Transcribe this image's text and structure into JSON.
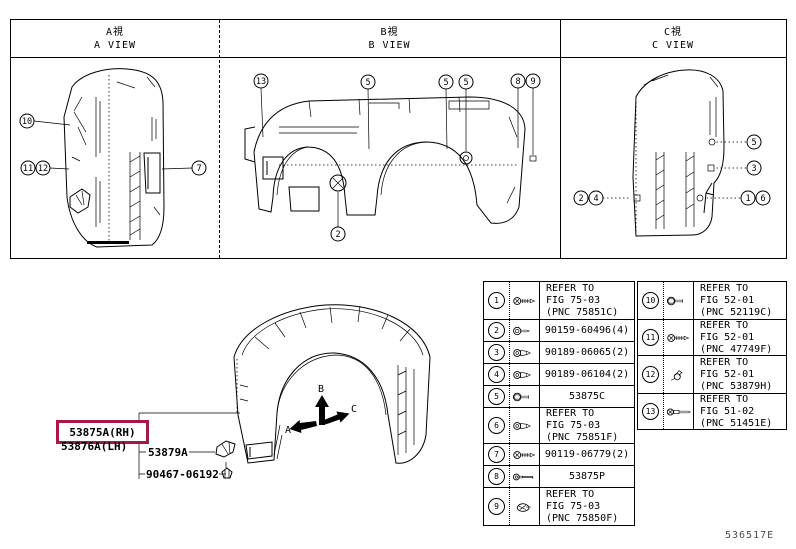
{
  "header": {
    "views": [
      {
        "jp": "A視",
        "en": "A VIEW"
      },
      {
        "jp": "B視",
        "en": "B VIEW"
      },
      {
        "jp": "C視",
        "en": "C VIEW"
      }
    ]
  },
  "view_a": {
    "callouts": [
      "10",
      "11",
      "12",
      "7"
    ]
  },
  "view_b": {
    "callouts": [
      "13",
      "5",
      "5",
      "5",
      "8",
      "9",
      "2"
    ]
  },
  "view_c": {
    "callouts": [
      "2",
      "4",
      "5",
      "3",
      "1",
      "6"
    ]
  },
  "main_figure": {
    "part_rh": "53875A(RH)",
    "part_lh": "53876A(LH)",
    "part_branch_1": "53879A",
    "part_branch_2": "90467-06192",
    "dir_a": "A",
    "dir_b": "B",
    "dir_c": "C",
    "highlight_color": "#a8174a"
  },
  "parts_table": {
    "left_rows": [
      {
        "num": "1",
        "icon": "screw-icon",
        "ref": "REFER TO\nFIG 75-03\n(PNC 75851C)"
      },
      {
        "num": "2",
        "icon": "clip-icon",
        "ref": "90159-60496(4)"
      },
      {
        "num": "3",
        "icon": "rivet-icon",
        "ref": "90189-06065(2)"
      },
      {
        "num": "4",
        "icon": "rivet-icon",
        "ref": "90189-06104(2)"
      },
      {
        "num": "5",
        "icon": "bolt-icon",
        "ref": "53875C"
      },
      {
        "num": "6",
        "icon": "rivet-icon",
        "ref": "REFER TO\nFIG 75-03\n(PNC 75851F)"
      },
      {
        "num": "7",
        "icon": "screw-icon",
        "ref": "90119-06779(2)"
      },
      {
        "num": "8",
        "icon": "grommet-icon",
        "ref": "53875P"
      },
      {
        "num": "9",
        "icon": "wing-clip-icon",
        "ref": "REFER TO\nFIG 75-03\n(PNC 75850F)"
      }
    ],
    "right_rows": [
      {
        "num": "10",
        "icon": "bolt-icon",
        "ref": "REFER TO\nFIG 52-01\n(PNC 52119C)"
      },
      {
        "num": "11",
        "icon": "screw-icon",
        "ref": "REFER TO\nFIG 52-01\n(PNC 47749F)"
      },
      {
        "num": "12",
        "icon": "bent-clip-icon",
        "ref": "REFER TO\nFIG 52-01\n(PNC 53879H)"
      },
      {
        "num": "13",
        "icon": "long-bolt-icon",
        "ref": "REFER TO\nFIG 51-02\n(PNC 51451E)"
      }
    ]
  },
  "footer": {
    "figure_code": "536517E"
  }
}
